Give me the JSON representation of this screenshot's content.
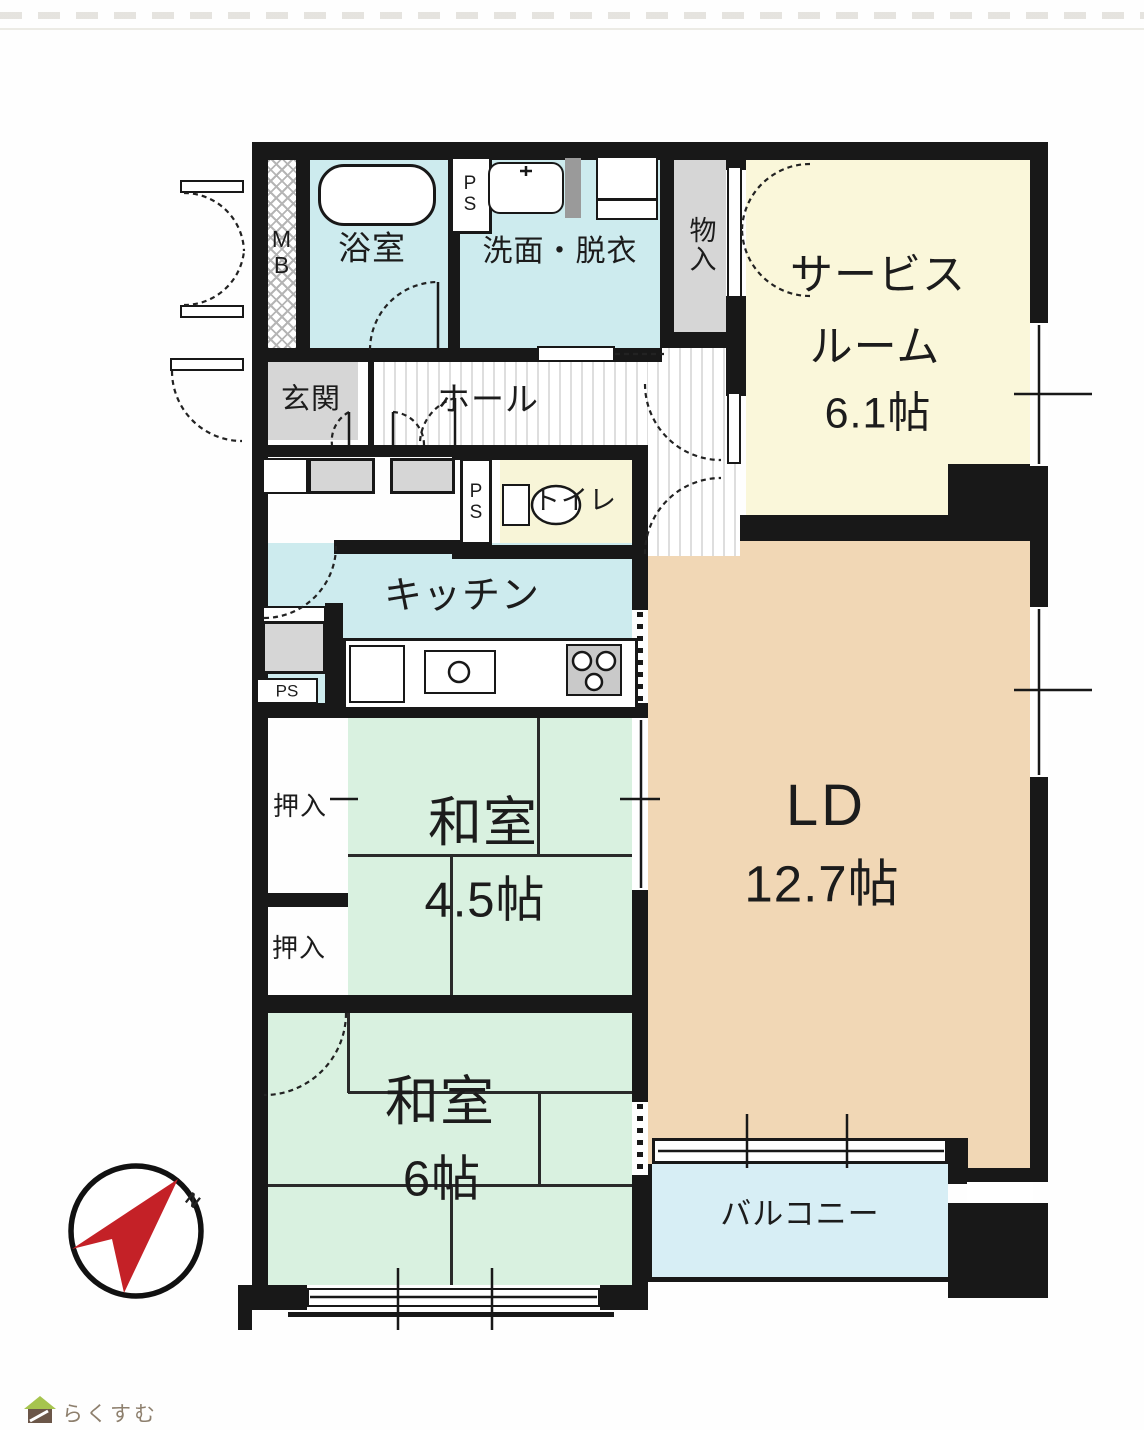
{
  "rooms": {
    "bath": {
      "label": "浴室"
    },
    "washroom": {
      "label": "洗面・脱衣"
    },
    "storage_top": {
      "label": "物入"
    },
    "service_room": {
      "name_line1": "サービス",
      "name_line2": "ルーム",
      "size": "6.1帖"
    },
    "entrance": {
      "label": "玄関"
    },
    "hall": {
      "label": "ホール"
    },
    "toilet": {
      "label": "トイレ"
    },
    "kitchen": {
      "label": "キッチン"
    },
    "closet_upper": {
      "label": "押入"
    },
    "closet_lower": {
      "label": "押入"
    },
    "japanese_room_45": {
      "name": "和室",
      "size": "4.5帖"
    },
    "living_dining": {
      "name": "LD",
      "size": "12.7帖"
    },
    "japanese_room_6": {
      "name": "和室",
      "size": "6帖"
    },
    "balcony": {
      "label": "バルコニー"
    },
    "meter_box": {
      "label": "MB"
    },
    "pipe_space_top": {
      "label": "PS"
    },
    "pipe_space_toilet": {
      "label": "PS"
    },
    "pipe_space_kitchen": {
      "label": "PS"
    }
  },
  "compass": {
    "north_label": "N"
  },
  "footer": {
    "logo_text": "らくすむ"
  },
  "colors": {
    "wall": "#181818",
    "water": "#cdebee",
    "tatami": "#d9f1e0",
    "ld": "#f1d7b5",
    "service": "#faf7da",
    "toilet": "#f8f5d8",
    "balcony": "#d7eef5",
    "gray": "#d6d6d6",
    "compass_red": "#c42127",
    "logo_text_color": "#8d7f6d",
    "logo_roof": "#a6c44e",
    "logo_body": "#6b5648"
  }
}
